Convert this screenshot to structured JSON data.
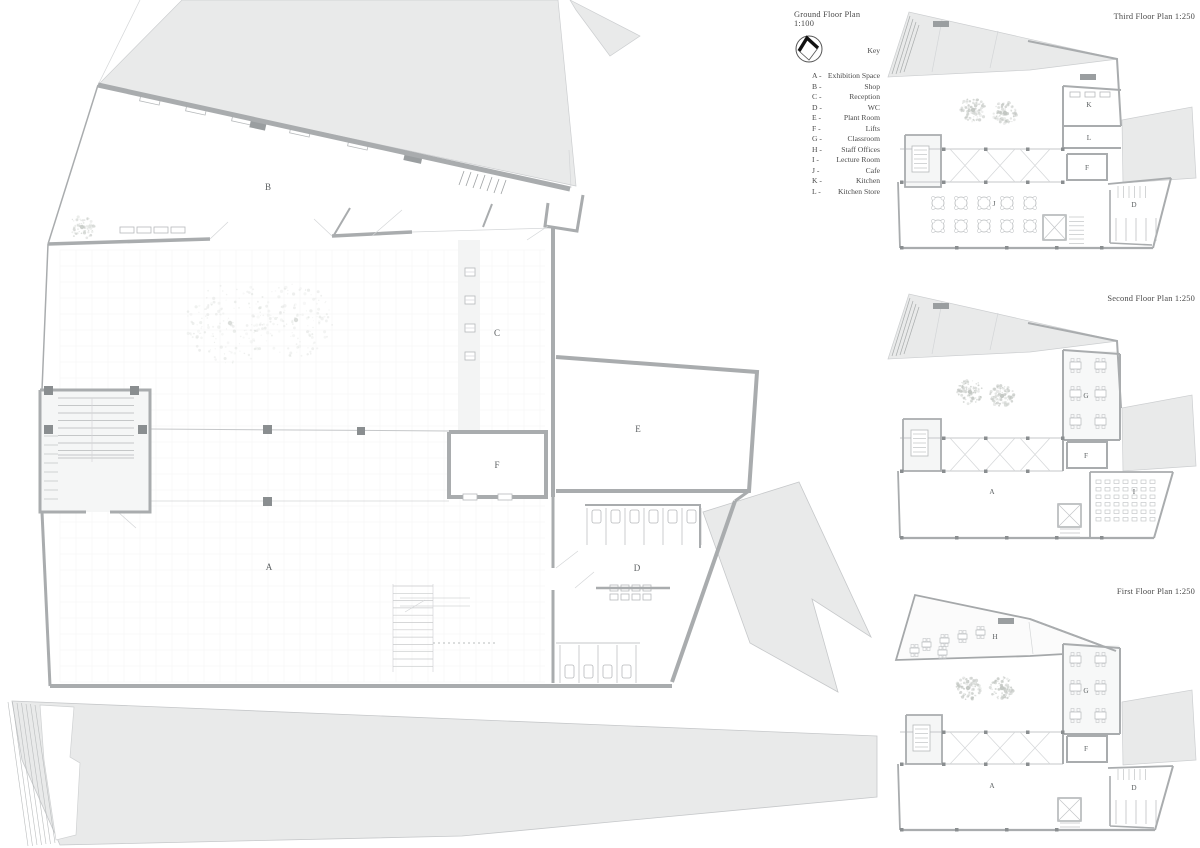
{
  "document": {
    "kind": "architectural floor plan sheet"
  },
  "key": {
    "heading": "Key",
    "entries": [
      {
        "prefix": "A -",
        "label": "Exhibition Space"
      },
      {
        "prefix": "B -",
        "label": "Shop"
      },
      {
        "prefix": "C -",
        "label": "Reception"
      },
      {
        "prefix": "D -",
        "label": "WC"
      },
      {
        "prefix": "E -",
        "label": "Plant Room"
      },
      {
        "prefix": "F -",
        "label": "Lifts"
      },
      {
        "prefix": "G -",
        "label": "Classroom"
      },
      {
        "prefix": "H -",
        "label": "Staff Offices"
      },
      {
        "prefix": "I -",
        "label": "Lecture Room"
      },
      {
        "prefix": "J -",
        "label": "Cafe"
      },
      {
        "prefix": "K -",
        "label": "Kitchen"
      },
      {
        "prefix": "L -",
        "label": "Kitchen Store"
      }
    ]
  },
  "plans": {
    "ground": {
      "title": "Ground Floor Plan 1:100",
      "scale": "1:100",
      "labels": {
        "a": "A",
        "b": "B",
        "c": "C",
        "d": "D",
        "e": "E",
        "f": "F"
      }
    },
    "third": {
      "title": "Third Floor Plan 1:250",
      "scale": "1:250",
      "labels": {
        "k": "K",
        "l": "L",
        "f": "F",
        "d": "D",
        "j": "J"
      }
    },
    "second": {
      "title": "Second Floor Plan 1:250",
      "scale": "1:250",
      "labels": {
        "g": "G",
        "f": "F",
        "a": "A",
        "i": "I"
      }
    },
    "first": {
      "title": "First Floor Plan 1:250",
      "scale": "1:250",
      "labels": {
        "h": "H",
        "g": "G",
        "f": "F",
        "a": "A",
        "d": "D"
      }
    }
  },
  "colors": {
    "site_grey": "#e9eaea",
    "wall_grey": "#a9acae",
    "text_grey": "#4a4a4a",
    "label_grey": "#5c6062"
  }
}
